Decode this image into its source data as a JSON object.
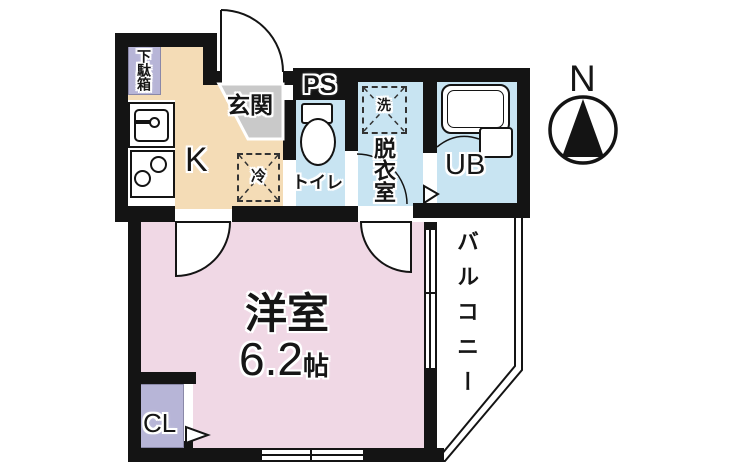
{
  "colors": {
    "wall": "#141414",
    "kitchen-floor": "#f4dcb6",
    "entrance-floor": "#c9c9c9",
    "cabinet": "#b7b5d7",
    "wet-floor": "#c8e4f2",
    "room-floor": "#f0d8e5"
  },
  "labels": {
    "compass_north": "N",
    "shoe_box": "下駄箱",
    "entrance": "玄関",
    "kitchen": "K",
    "pipe_space": "PS",
    "toilet": "トイレ",
    "refrigerator": "冷",
    "washing_machine": "洗",
    "dressing_room": "脱衣室",
    "unit_bath": "UB",
    "western_room": "洋室",
    "room_size_value": "6.2",
    "room_size_unit": "帖",
    "closet": "CL",
    "balcony": "バルコニー"
  }
}
